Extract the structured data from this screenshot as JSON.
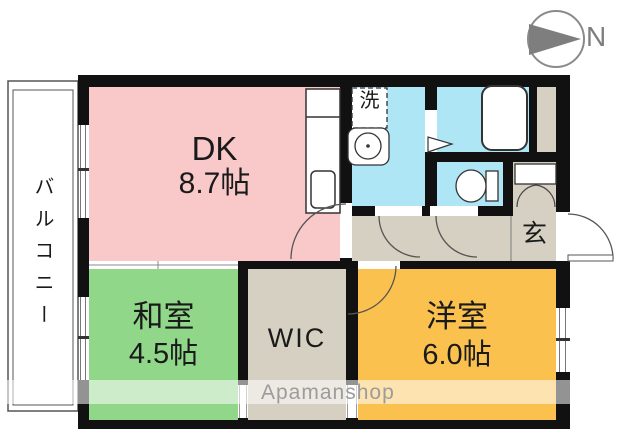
{
  "compass": {
    "north_label": "N"
  },
  "balcony": {
    "label": "バルコニー"
  },
  "rooms": {
    "dk": {
      "name": "DK",
      "size": "8.7帖"
    },
    "japanese_room": {
      "name": "和室",
      "size": "4.5帖"
    },
    "western_room": {
      "name": "洋室",
      "size": "6.0帖"
    },
    "wic": {
      "name": "WIC"
    },
    "entrance": {
      "name": "玄"
    },
    "laundry": {
      "name": "洗"
    }
  },
  "watermark": {
    "text": "Apamanshop"
  },
  "colors": {
    "dk": "#f9c9c9",
    "japanese_room": "#90d78a",
    "western_room": "#fbc14e",
    "wet_area": "#aee6f6",
    "corridor": "#d5d0c2",
    "wall": "#111111"
  }
}
